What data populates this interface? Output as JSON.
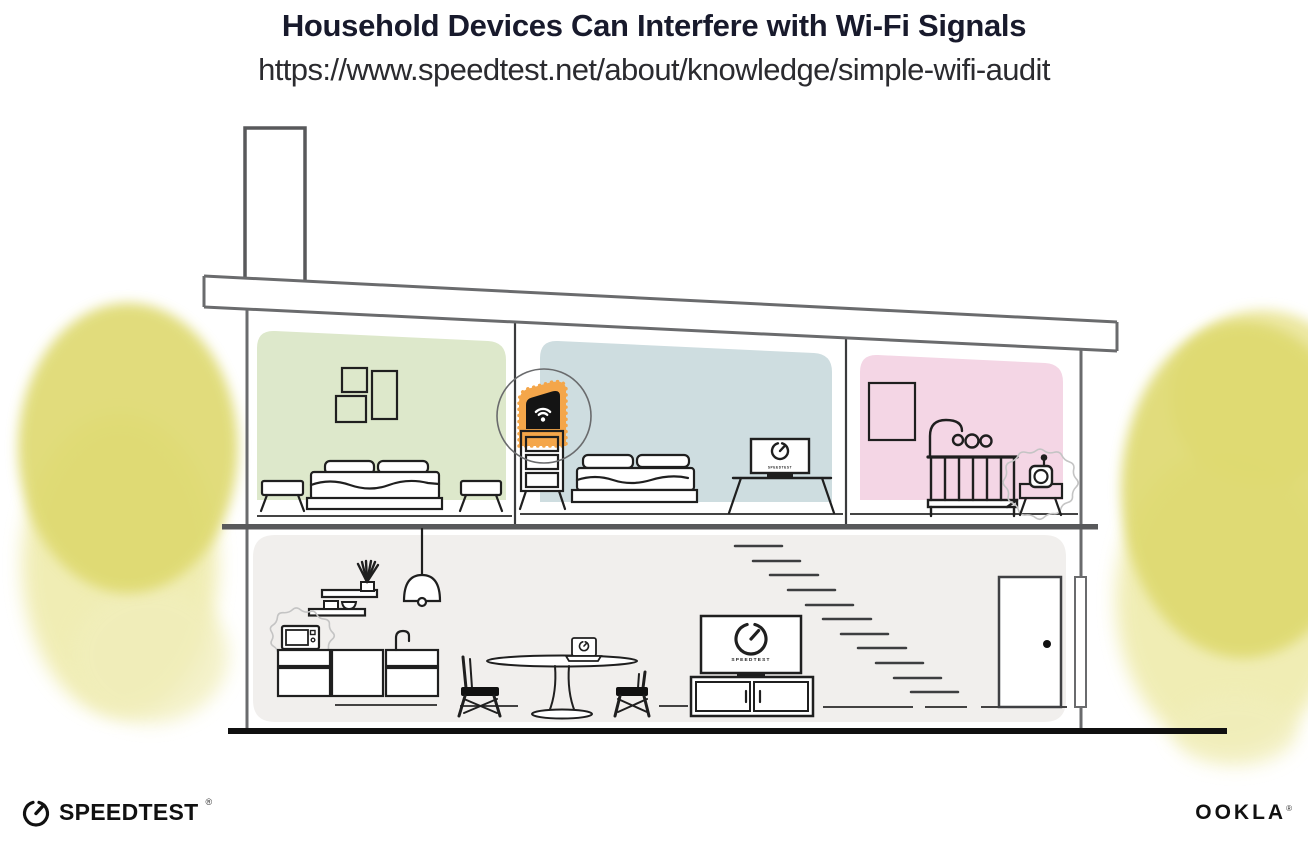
{
  "header": {
    "title": "Household Devices Can Interfere with Wi-Fi Signals",
    "url": "https://www.speedtest.net/about/knowledge/simple-wifi-audit"
  },
  "footer": {
    "speedtest_wordmark": "SPEEDTEST",
    "ookla_wordmark": "OOKLA",
    "registered_mark": "®"
  },
  "screens": {
    "living_tv_label": "SPEEDTEST",
    "bedroom_tv_label": "SPEEDTEST"
  },
  "colors": {
    "room_green": "#dde8cb",
    "room_blue": "#cedde0",
    "room_pink": "#f4d6e5",
    "lower_floor_gray": "#f1efed",
    "foliage_dark": "#ded96e",
    "foliage_light": "#eeeaa8",
    "router_glow_orange": "#f4a64a",
    "title_navy": "#181a2c",
    "structure_gray": "#6d6e70",
    "ink_black": "#1f1f1f"
  }
}
